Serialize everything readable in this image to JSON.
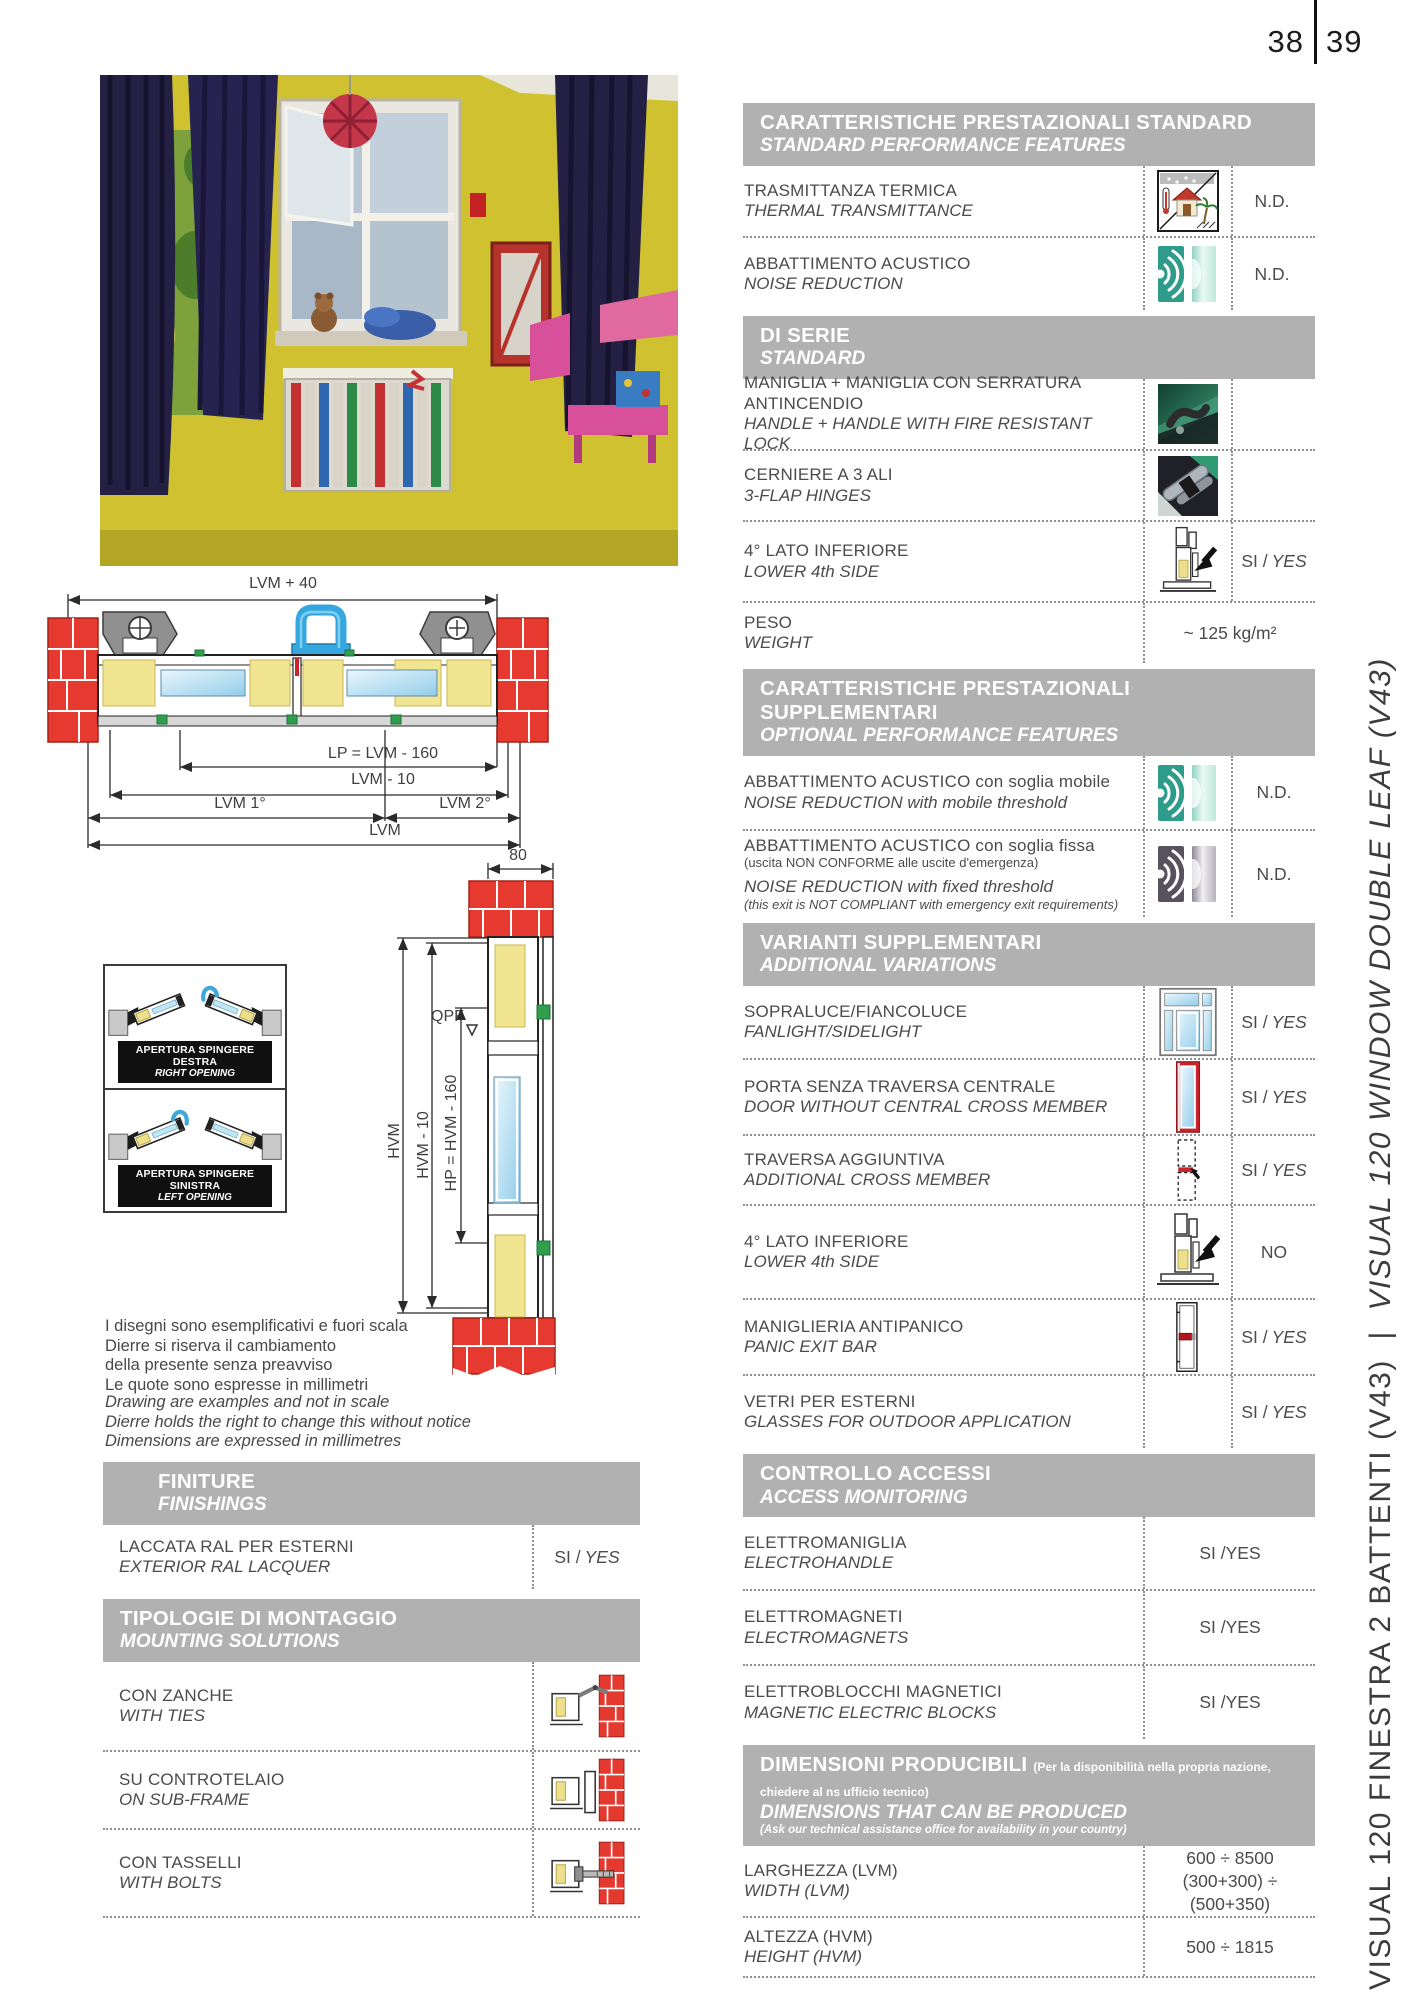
{
  "page": {
    "left_num": "38",
    "right_num": "39"
  },
  "sidebar": {
    "it": "VISUAL 120 FINESTRA 2 BATTENTI (V43)",
    "sep": "  |  ",
    "en": "VISUAL 120 WINDOW DOUBLE LEAF (V43)"
  },
  "drawing": {
    "dim_lvm40": "LVM + 40",
    "dim_lp": "LP = LVM - 160",
    "dim_lvm10": "LVM - 10",
    "dim_lvm1": "LVM 1°",
    "dim_lvm2": "LVM 2°",
    "dim_lvm": "LVM",
    "dim_80": "80",
    "dim_hvm": "HVM",
    "dim_hvm10": "HVM - 10",
    "dim_hp": "HP = HVM - 160",
    "qpf": "QPF",
    "opening_right_it": "APERTURA SPINGERE DESTRA",
    "opening_right_en": "RIGHT OPENING",
    "opening_left_it": "APERTURA SPINGERE SINISTRA",
    "opening_left_en": "LEFT OPENING",
    "disclaimer_it": [
      "I disegni sono esemplificativi e fuori scala",
      "Dierre si riserva il cambiamento",
      "della presente senza preavviso",
      "Le quote sono espresse in millimetri"
    ],
    "disclaimer_en": [
      "Drawing are examples and not in scale",
      "Dierre holds the right to change this without notice",
      "Dimensions are expressed in millimetres"
    ]
  },
  "finiture": {
    "header_it": "FINITURE",
    "header_en": "FINISHINGS",
    "row_it": "LACCATA RAL PER ESTERNI",
    "row_en": "EXTERIOR RAL LACQUER",
    "value": "SI /",
    "value_en": "YES"
  },
  "montaggio": {
    "header_it": "TIPOLOGIE DI MONTAGGIO",
    "header_en": "MOUNTING SOLUTIONS",
    "rows": [
      {
        "it": "CON ZANCHE",
        "en": "WITH TIES",
        "icon": "ties-icon"
      },
      {
        "it": "SU CONTROTELAIO",
        "en": "ON SUB-FRAME",
        "icon": "subframe-icon"
      },
      {
        "it": "CON TASSELLI",
        "en": "WITH BOLTS",
        "icon": "bolts-icon"
      }
    ]
  },
  "features": {
    "sections": [
      {
        "h_it": "CARATTERISTICHE PRESTAZIONALI STANDARD",
        "h_en": "STANDARD PERFORMANCE FEATURES",
        "rows": [
          {
            "it": "TRASMITTANZA TERMICA",
            "en": "THERMAL TRANSMITTANCE",
            "icon": "thermal-transmittance-icon",
            "v": "N.D.",
            "v_en": ""
          },
          {
            "it": "ABBATTIMENTO ACUSTICO",
            "en": "NOISE REDUCTION",
            "icon": "noise-reduction-icon",
            "v": "N.D.",
            "v_en": ""
          }
        ]
      },
      {
        "h_it": "DI SERIE",
        "h_en": "STANDARD",
        "rows": [
          {
            "it": "MANIGLIA + MANIGLIA CON SERRATURA ANTINCENDIO",
            "en": "HANDLE + HANDLE WITH FIRE RESISTANT LOCK",
            "icon": "handle-photo-icon",
            "v": "",
            "v_en": ""
          },
          {
            "it": "CERNIERE A 3 ALI",
            "en": "3-FLAP HINGES",
            "icon": "hinges-photo-icon",
            "v": "",
            "v_en": ""
          },
          {
            "it": "4° LATO INFERIORE",
            "en": "LOWER 4th SIDE",
            "icon": "lower-4th-side-icon",
            "v": "SI /",
            "v_en": "YES"
          },
          {
            "it": "PESO",
            "en": "WEIGHT",
            "icon": "",
            "v": "~ 125 kg/m²",
            "v_en": ""
          }
        ]
      },
      {
        "h_it": "CARATTERISTICHE PRESTAZIONALI SUPPLEMENTARI",
        "h_en": "OPTIONAL PERFORMANCE FEATURES",
        "rows": [
          {
            "it": "ABBATTIMENTO ACUSTICO con soglia mobile",
            "en": "NOISE REDUCTION with mobile threshold",
            "icon": "noise-reduction-icon",
            "v": "N.D.",
            "v_en": ""
          },
          {
            "it": "ABBATTIMENTO ACUSTICO con soglia fissa",
            "note_it": "(uscita NON CONFORME alle uscite d'emergenza)",
            "en": "NOISE REDUCTION with fixed threshold",
            "note_en": "(this exit is NOT COMPLIANT with emergency exit requirements)",
            "icon": "noise-reduction-fixed-icon",
            "v": "N.D.",
            "v_en": ""
          }
        ]
      },
      {
        "h_it": "VARIANTI SUPPLEMENTARI",
        "h_en": "ADDITIONAL VARIATIONS",
        "rows": [
          {
            "it": "SOPRALUCE/FIANCOLUCE",
            "en": "FANLIGHT/SIDELIGHT",
            "icon": "fanlight-icon",
            "v": "SI /",
            "v_en": "YES"
          },
          {
            "it": "PORTA SENZA TRAVERSA CENTRALE",
            "en": "DOOR WITHOUT CENTRAL CROSS MEMBER",
            "icon": "door-icon",
            "v": "SI /",
            "v_en": "YES"
          },
          {
            "it": "TRAVERSA AGGIUNTIVA",
            "en": "ADDITIONAL CROSS MEMBER",
            "icon": "crossmember-icon",
            "v": "SI /",
            "v_en": "YES"
          },
          {
            "it": "4° LATO INFERIORE",
            "en": "LOWER 4th SIDE",
            "icon": "lower-4th-side-icon",
            "v": "NO",
            "v_en": ""
          },
          {
            "it": "MANIGLIERIA ANTIPANICO",
            "en": "PANIC EXIT BAR",
            "icon": "panic-exit-bar-icon",
            "v": "SI /",
            "v_en": "YES"
          },
          {
            "it": "VETRI PER ESTERNI",
            "en": "GLASSES FOR OUTDOOR APPLICATION",
            "icon": "",
            "v": "SI /",
            "v_en": "YES"
          }
        ]
      },
      {
        "h_it": "CONTROLLO ACCESSI",
        "h_en": "ACCESS MONITORING",
        "rows": [
          {
            "it": "ELETTROMANIGLIA",
            "en": "ELECTROHANDLE",
            "v": "SI /",
            "v_en": "YES"
          },
          {
            "it": "ELETTROMAGNETI",
            "en": "ELECTROMAGNETS",
            "v": "SI /",
            "v_en": "YES"
          },
          {
            "it": "ELETTROBLOCCHI MAGNETICI",
            "en": "MAGNETIC ELECTRIC BLOCKS",
            "v": "SI /",
            "v_en": "YES"
          }
        ]
      },
      {
        "h_it": "DIMENSIONI PRODUCIBILI",
        "h_note_it": "(Per la disponibilità nella propria nazione, chiedere al ns ufficio tecnico)",
        "h_en": "DIMENSIONS THAT CAN BE PRODUCED",
        "h_note_en": "(Ask our technical assistance office for availability in your country)",
        "rows": [
          {
            "it": "LARGHEZZA (LVM)",
            "en": "WIDTH (LVM)",
            "v": "600 ÷ 8500",
            "v2": "(300+300) ÷ (500+350)"
          },
          {
            "it": "ALTEZZA (HVM)",
            "en": "HEIGHT (HVM)",
            "v": "500 ÷ 1815",
            "v2": ""
          }
        ]
      }
    ]
  }
}
